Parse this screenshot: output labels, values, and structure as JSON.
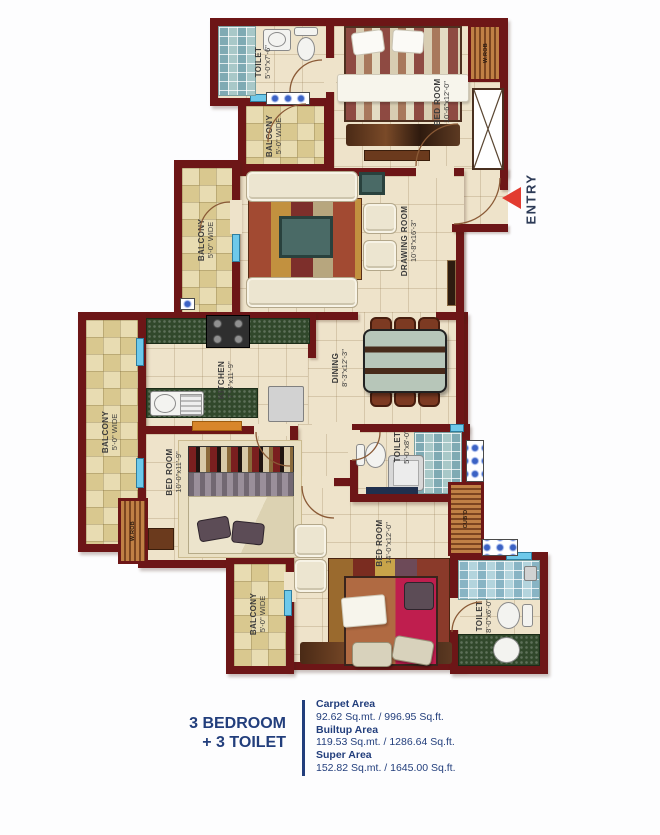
{
  "plan": {
    "entry_label": "ENTRY",
    "rooms": {
      "toilet_top": {
        "name": "TOILET",
        "dims": "5'-0\"x7'-6\""
      },
      "balcony_top": {
        "name": "BALCONY",
        "dims": "5'-0\" WIDE"
      },
      "bedroom_top": {
        "name": "BED ROOM",
        "dims": "10'-6\"x12'-0\""
      },
      "drawing_room": {
        "name": "DRAWING ROOM",
        "dims": "10'-8\"x16'-3\""
      },
      "balcony_upper_left": {
        "name": "BALCONY",
        "dims": "5'-0\" WIDE"
      },
      "kitchen": {
        "name": "KITCHEN",
        "dims": "7'-6\"x11'-9\""
      },
      "dining": {
        "name": "DINING",
        "dims": "8'-3\"x12'-3\""
      },
      "balcony_lower_left": {
        "name": "BALCONY",
        "dims": "5'-0\" WIDE"
      },
      "bedroom_left": {
        "name": "BED ROOM",
        "dims": "10'-0\"x11'-9\""
      },
      "toilet_middle": {
        "name": "TOILET",
        "dims": "5'-0\"x8'-0\""
      },
      "bedroom_bottom": {
        "name": "BED ROOM",
        "dims": "14'-0\"x12'-0\""
      },
      "balcony_bottom": {
        "name": "BALCONY",
        "dims": "5'-0\" WIDE"
      },
      "toilet_bottom_right": {
        "name": "TOILET",
        "dims": "8'-0\"x6'-0\""
      },
      "wardrobe_top": "W.ROB",
      "wardrobe_left": "W.ROB",
      "cupboard": "CUB'D"
    }
  },
  "legend": {
    "title_line1": "3 BEDROOM",
    "title_line2": "+ 3 TOILET",
    "areas": [
      {
        "label": "Carpet Area",
        "value": "92.62 Sq.mt. / 996.95 Sq.ft."
      },
      {
        "label": "Builtup Area",
        "value": "119.53 Sq.mt. / 1286.64 Sq.ft."
      },
      {
        "label": "Super Area",
        "value": "152.82 Sq.mt. / 1645.00 Sq.ft."
      }
    ]
  },
  "colors": {
    "wall": "#6d1617",
    "navy": "#223e7c",
    "entry_red": "#e23b30"
  }
}
